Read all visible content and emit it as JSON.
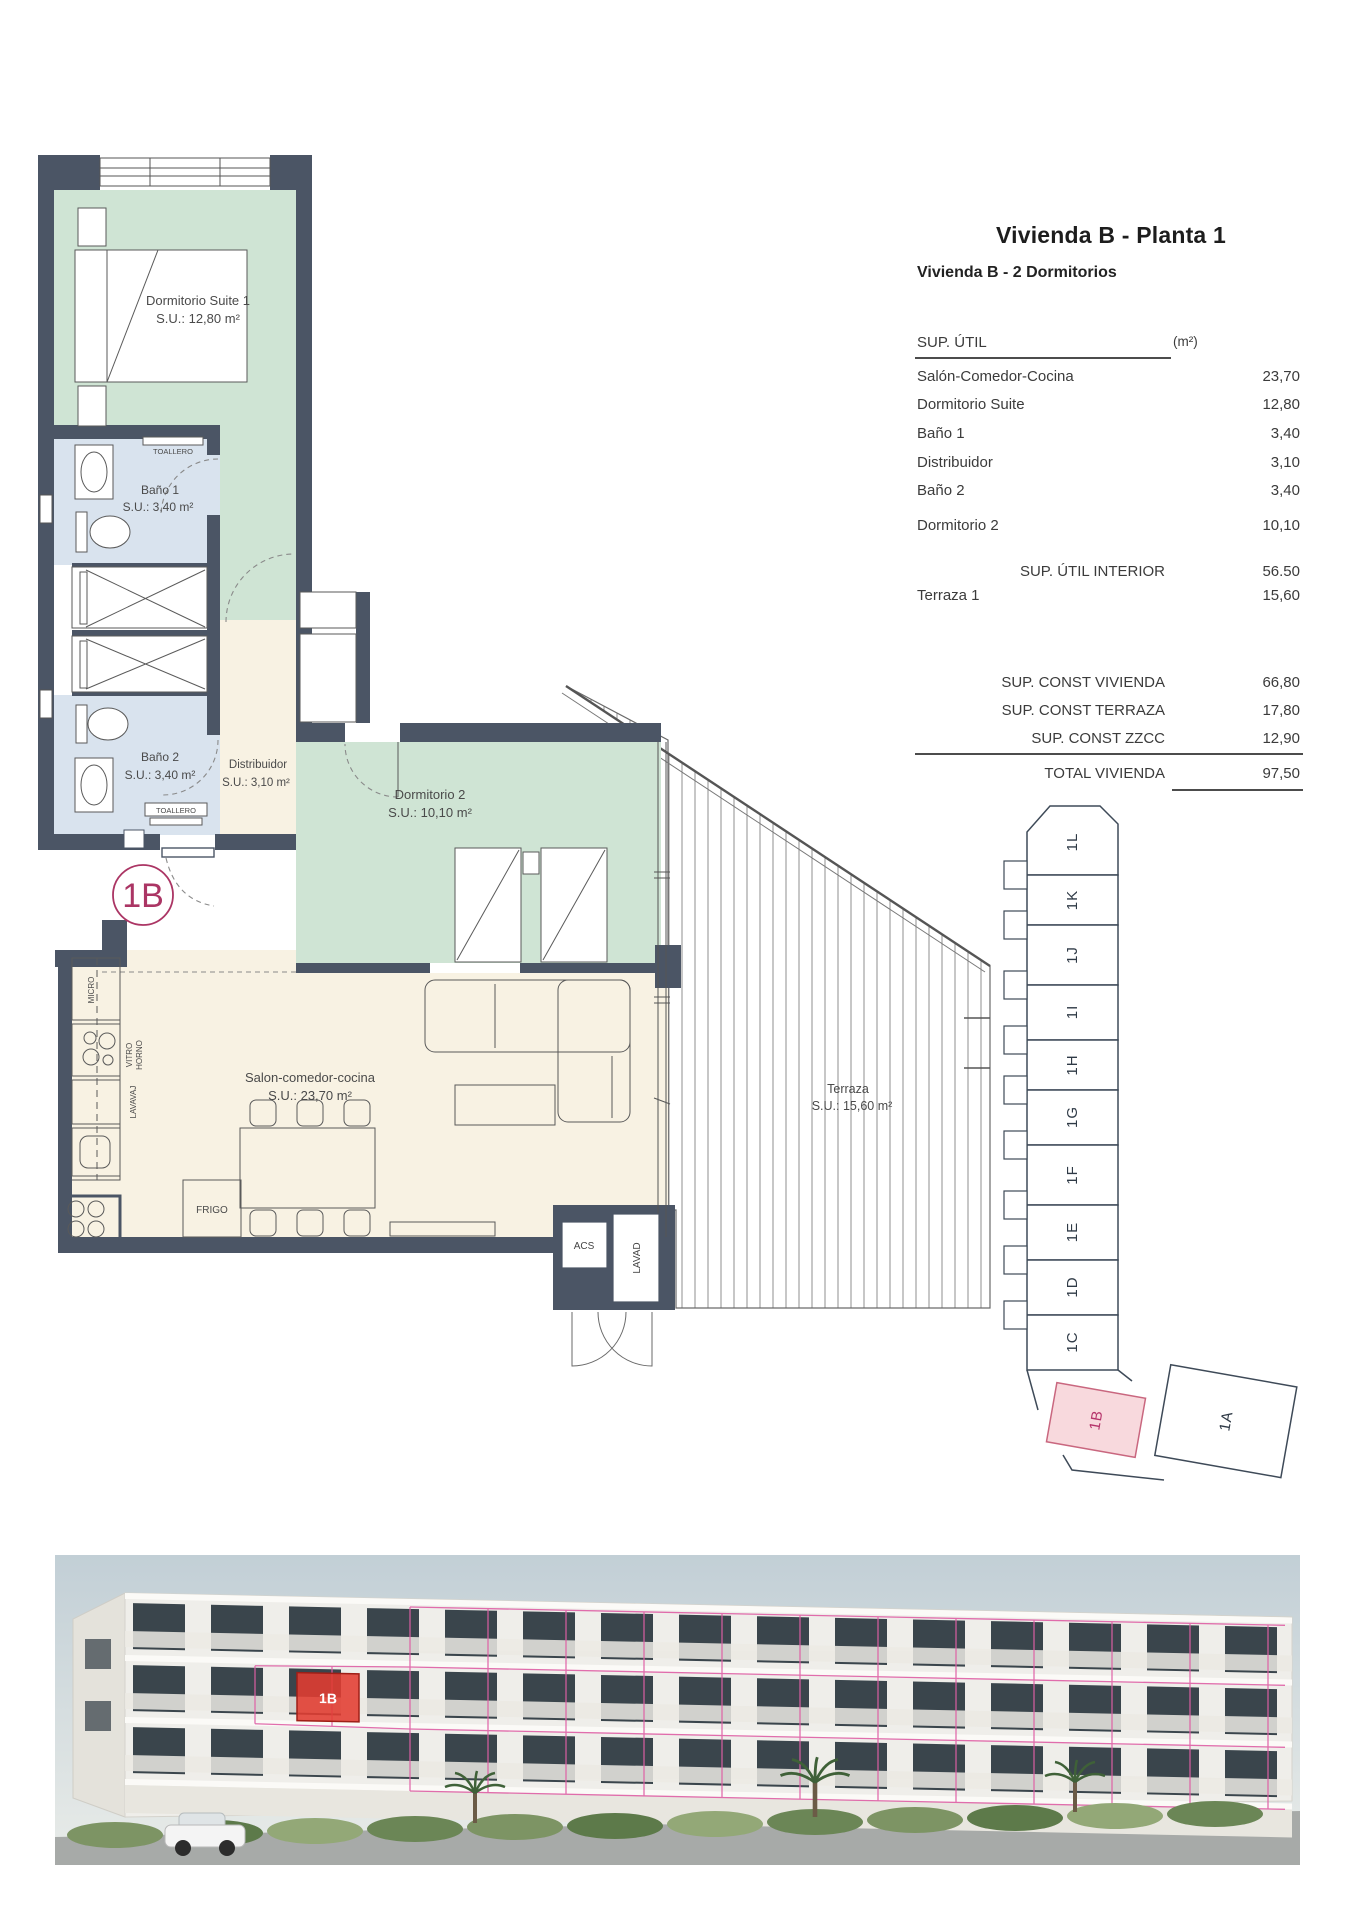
{
  "header": {
    "title": "Vivienda B - Planta 1",
    "subtitle": "Vivienda B - 2 Dormitorios"
  },
  "table": {
    "col_label": "SUP. ÚTIL",
    "col_unit": "(m²)",
    "rows": [
      {
        "label": "Salón-Comedor-Cocina",
        "value": "23,70"
      },
      {
        "label": "Dormitorio Suite",
        "value": "12,80"
      },
      {
        "label": "Baño 1",
        "value": "3,40"
      },
      {
        "label": "Distribuidor",
        "value": "3,10"
      },
      {
        "label": "Baño 2",
        "value": "3,40"
      },
      {
        "label": "Dormitorio 2",
        "value": "10,10"
      }
    ],
    "interior_total": {
      "label": "SUP. ÚTIL INTERIOR",
      "value": "56.50"
    },
    "terrace_row": {
      "label": "Terraza 1",
      "value": "15,60"
    },
    "const_rows": [
      {
        "label": "SUP. CONST VIVIENDA",
        "value": "66,80"
      },
      {
        "label": "SUP. CONST TERRAZA",
        "value": "17,80"
      },
      {
        "label": "SUP. CONST ZZCC",
        "value": "12,90"
      }
    ],
    "total_row": {
      "label": "TOTAL VIVIENDA",
      "value": "97,50"
    }
  },
  "plan": {
    "badge": "1B",
    "rooms": {
      "suite": {
        "name": "Dormitorio Suite 1",
        "area": "S.U.: 12,80 m²"
      },
      "bano1": {
        "name": "Baño 1",
        "area": "S.U.: 3,40 m²"
      },
      "bano2": {
        "name": "Baño 2",
        "area": "S.U.: 3,40 m²"
      },
      "distribuidor": {
        "name": "Distribuidor",
        "area": "S.U.: 3,10 m²"
      },
      "dorm2": {
        "name": "Dormitorio 2",
        "area": "S.U.: 10,10 m²"
      },
      "salon": {
        "name": "Salon-comedor-cocina",
        "area": "S.U.: 23,70 m²"
      },
      "terraza": {
        "name": "Terraza",
        "area": "S.U.: 15,60 m²"
      }
    },
    "fixtures": {
      "toallero": "TOALLERO",
      "micro": "MICRO",
      "vitro": "VITRO",
      "horno": "HORNO",
      "lavavaj": "LAVAVAJ",
      "frigo": "FRIGO",
      "acs": "ACS",
      "lavad": "LAVAD"
    }
  },
  "keyplan": {
    "units": [
      "1L",
      "1K",
      "1J",
      "1I",
      "1H",
      "1G",
      "1F",
      "1E",
      "1D",
      "1C"
    ],
    "unit_b": "1B",
    "unit_a": "1A",
    "highlighted": "1B"
  },
  "photo": {
    "highlight_label": "1B"
  },
  "colors": {
    "wall": "#4b5565",
    "room_green": "#cfe4d4",
    "room_blue": "#d9e3ee",
    "room_cream": "#f8f2e3",
    "badge_pink": "#ab3564",
    "keyplan_highlight_fill": "#f8d9dd",
    "photo_wireframe_pink": "#df5fa5",
    "photo_highlight_red": "#e23c31"
  }
}
